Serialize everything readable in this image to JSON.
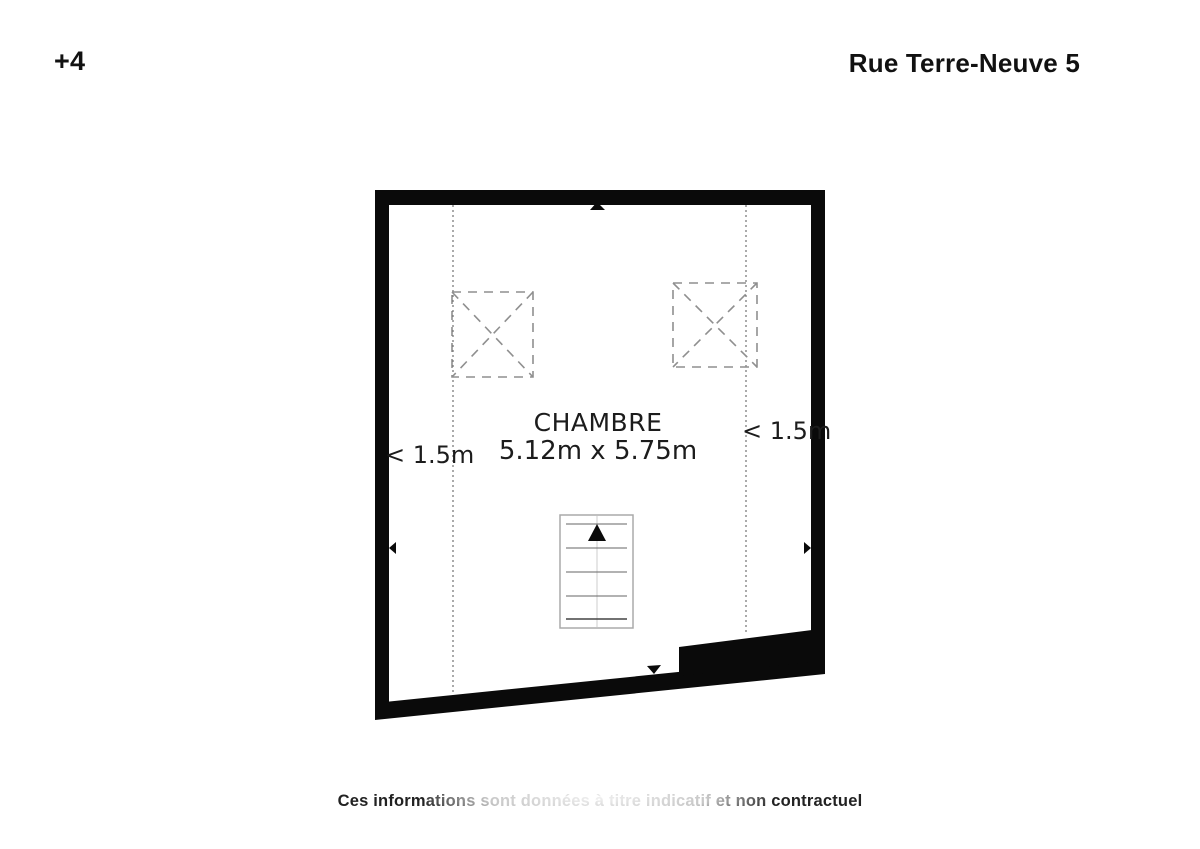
{
  "header": {
    "floor_label": "+4",
    "address": "Rue Terre-Neuve 5"
  },
  "plan": {
    "room": {
      "name": "CHAMBRE",
      "dimensions": "5.12m x 5.75m"
    },
    "height_labels": {
      "left": "< 1.5m",
      "right": "< 1.5m"
    },
    "icons": [
      "skylight-cross-icon",
      "staircase-icon",
      "arrow-up-icon",
      "arrow-down-icon",
      "arrow-left-icon",
      "arrow-right-icon"
    ]
  },
  "footer": {
    "disclaimer": "Ces informations sont données à titre indicatif et non contractuel"
  },
  "colors": {
    "wall": "#0a0a0a",
    "dashed_gray": "#8f8f8f",
    "dotted_dark": "#555555",
    "stair_outline": "#aaaaaa",
    "text": "#1c1c1c"
  }
}
